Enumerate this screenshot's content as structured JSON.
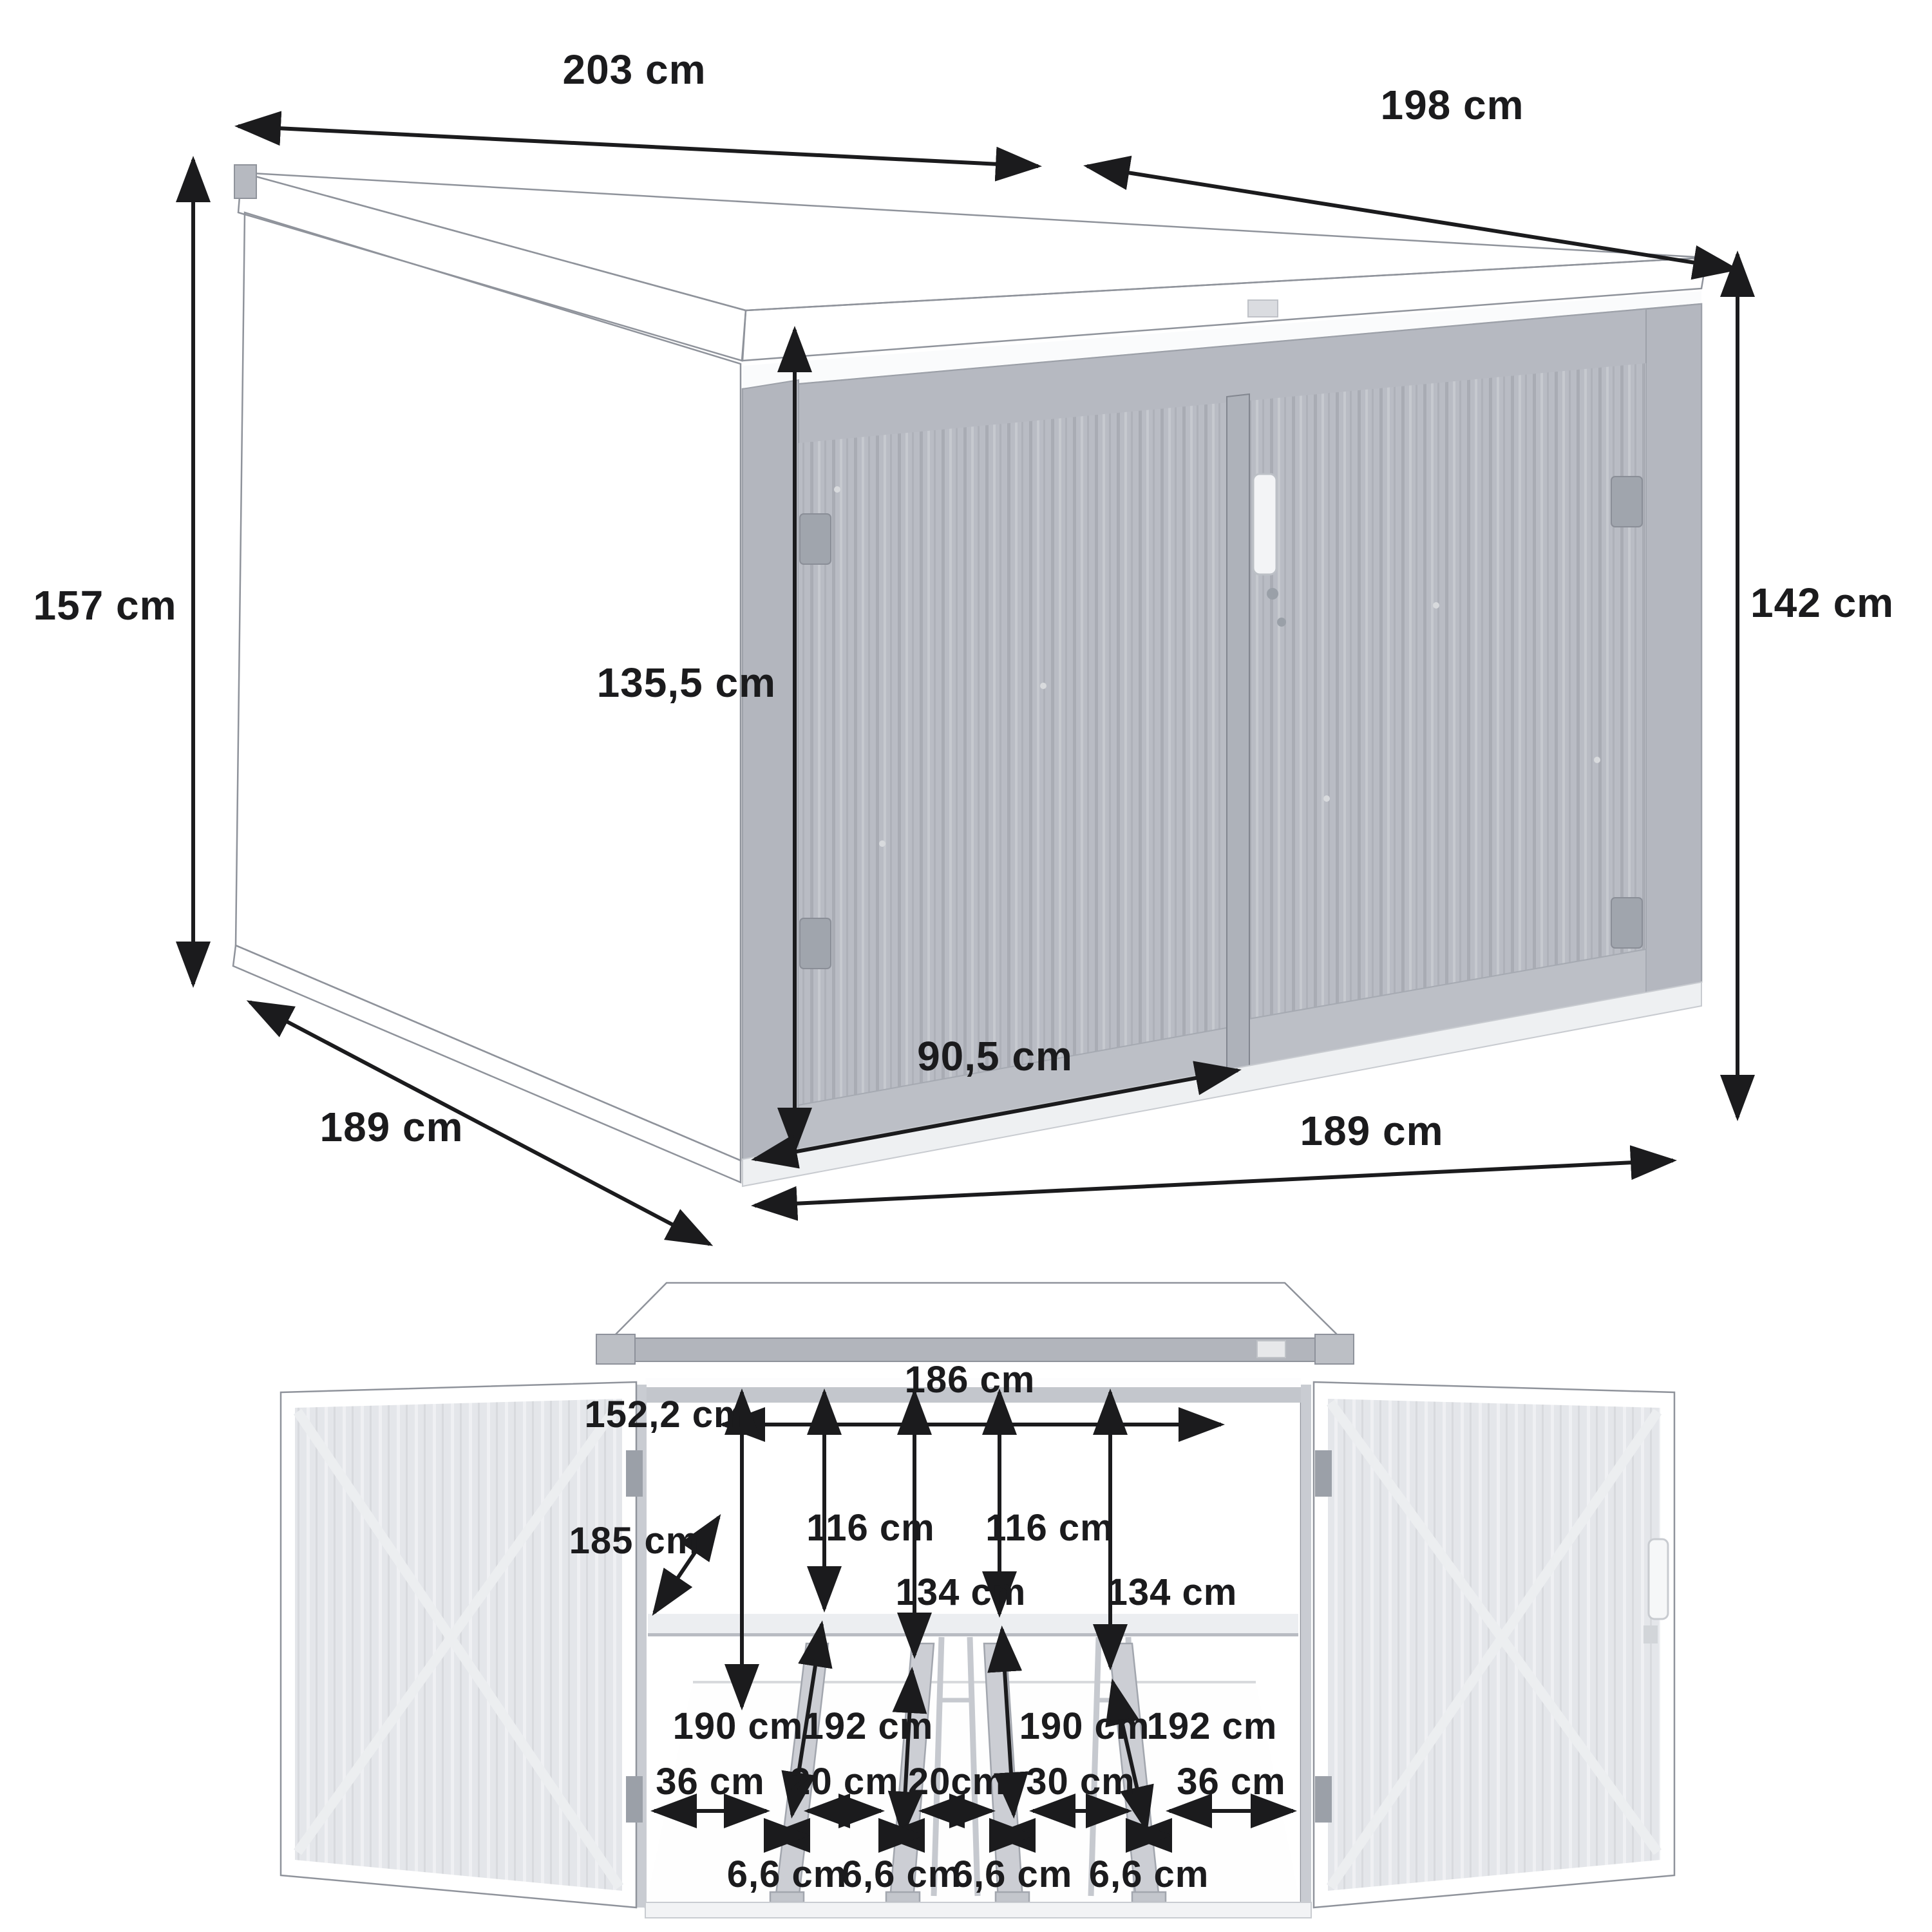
{
  "diagram": {
    "subject": "Metal bicycle storage shed dimension diagram",
    "unit": "cm",
    "views": [
      "perspective-exterior",
      "front-open-interior"
    ]
  },
  "colors": {
    "annotation": "#1b1b1d",
    "background": "#ffffff",
    "shed_panel": "#b9bcc4",
    "shed_side": "#a2a5ad",
    "roof": "#9b9ea6",
    "open_door": "#e4e6ea",
    "interior": "#d9dbdf",
    "floor": "#ffffff"
  },
  "top": {
    "roof_side_length": "203 cm",
    "roof_front_length": "198 cm",
    "height_rear": "157 cm",
    "height_front": "142 cm",
    "door_height": "135,5 cm",
    "door_width": "90,5 cm",
    "depth": "189 cm",
    "front_width": "189 cm"
  },
  "front": {
    "interior_width": "186 cm",
    "interior_height": "152,2 cm",
    "hook_height_left": "116 cm",
    "hook_height_right": "116 cm",
    "shelf_height_left": "134 cm",
    "shelf_height_right": "134 cm",
    "interior_depth": "185 cm",
    "rail_length_1": "190 cm",
    "rail_length_2": "192 cm",
    "rail_length_3": "190 cm",
    "rail_length_4": "192 cm",
    "gap_left_wall": "36 cm",
    "gap_rail_1_2": "20 cm",
    "gap_rail_2_3": "20cm",
    "gap_rail_3_4": "30 cm",
    "gap_right_wall": "36 cm",
    "rail_width_1": "6,6 cm",
    "rail_width_2": "6,6 cm",
    "rail_width_3": "6,6 cm",
    "rail_width_4": "6,6 cm"
  }
}
